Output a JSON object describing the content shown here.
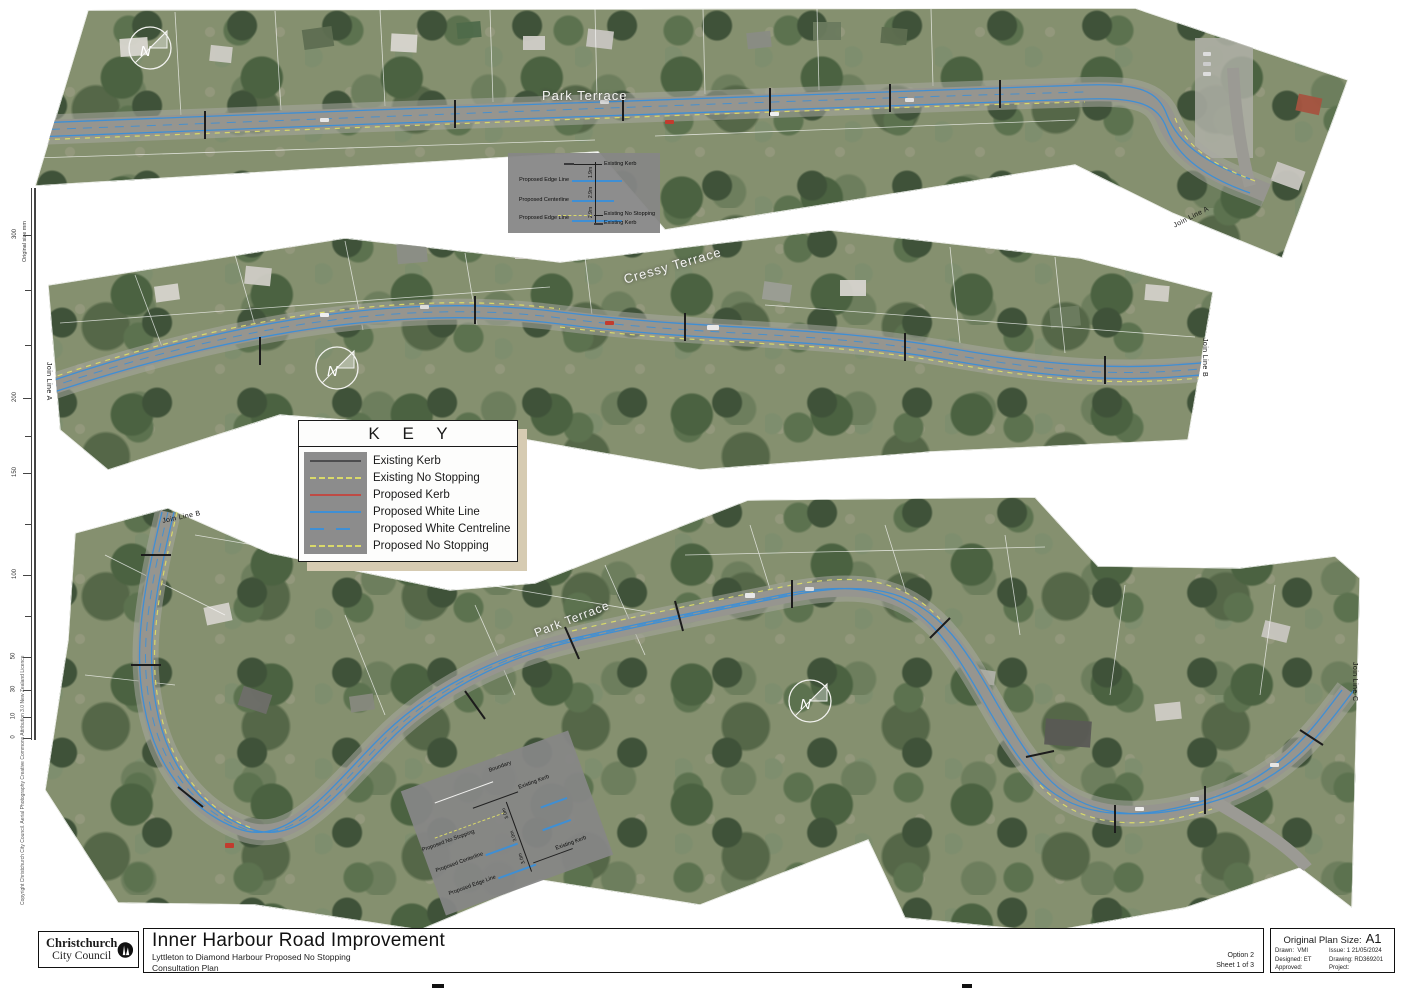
{
  "meta": {
    "north_label": "N",
    "colors": {
      "existing_kerb": "#4d4d4f",
      "existing_no_stopping": "#d9d96a",
      "proposed_kerb": "#bf4b45",
      "proposed_white_line": "#3f8fd4",
      "proposed_no_stopping": "#d9d96a",
      "key_shadow": "#d6cbb2"
    }
  },
  "ruler": {
    "caption": "Original size mm",
    "ticks": [
      {
        "label": "300"
      },
      {
        "label": "200"
      },
      {
        "label": "150"
      },
      {
        "label": "100"
      },
      {
        "label": "50"
      },
      {
        "label": "30"
      },
      {
        "label": "10"
      },
      {
        "label": "0"
      }
    ]
  },
  "copyright": "Copyright Christchurch City Council. Aerial Photography Creative Commons Attribution 3.0 New Zealand Licence",
  "key": {
    "title": "K E Y",
    "entries": [
      {
        "label": "Existing Kerb"
      },
      {
        "label": "Existing No Stopping"
      },
      {
        "label": "Proposed Kerb"
      },
      {
        "label": "Proposed White Line"
      },
      {
        "label": "Proposed White Centreline"
      },
      {
        "label": "Proposed No Stopping"
      }
    ]
  },
  "panels": {
    "top": {
      "street": "Park Terrace",
      "join_right": "Join Line A"
    },
    "middle": {
      "street": "Cressy Terrace",
      "join_left": "Join Line A",
      "join_right": "Join Line B"
    },
    "bottom": {
      "street": "Park Terrace",
      "join_left": "Join Line B",
      "join_right": "Join Line C"
    }
  },
  "callout_top": {
    "kerb_top": "Existing Kerb",
    "edge1": "Proposed Edge Line",
    "center": "Proposed Centerline",
    "edge2": "Proposed Edge Line",
    "no_stopping": "Existing No Stopping",
    "kerb_bottom": "Existing Kerb",
    "dims": [
      "1.9m",
      "2.9m",
      "2.9m"
    ]
  },
  "callout_bottom": {
    "boundary": "Boundary",
    "kerb_top": "Existing Kerb",
    "no_stopping": "Proposed No Stopping",
    "center": "Proposed Centerline",
    "edge": "Proposed Edge Line",
    "kerb_bottom": "Existing Kerb",
    "dims": [
      "3.0m",
      "3.0m",
      "3.0m"
    ]
  },
  "titlebar": {
    "logo_line1": "Christchurch",
    "logo_line2": "City Council",
    "title": "Inner Harbour Road Improvement",
    "subtitle": "Lyttleton to Diamond Harbour Proposed No Stopping",
    "subtitle2": "Consultation Plan",
    "option": "Option 2",
    "sheet": "Sheet 1 of 3",
    "plan_size_label": "Original Plan Size:",
    "plan_size": "A1",
    "drawn_label": "Drawn:",
    "drawn": "VMI",
    "issue_label": "Issue:",
    "issue": "1  21/05/2024",
    "designed_label": "Designed:",
    "designed": "ET",
    "drawing_label": "Drawing:",
    "drawing": "RD369201",
    "approved_label": "Approved:",
    "project_label": "Project:"
  }
}
